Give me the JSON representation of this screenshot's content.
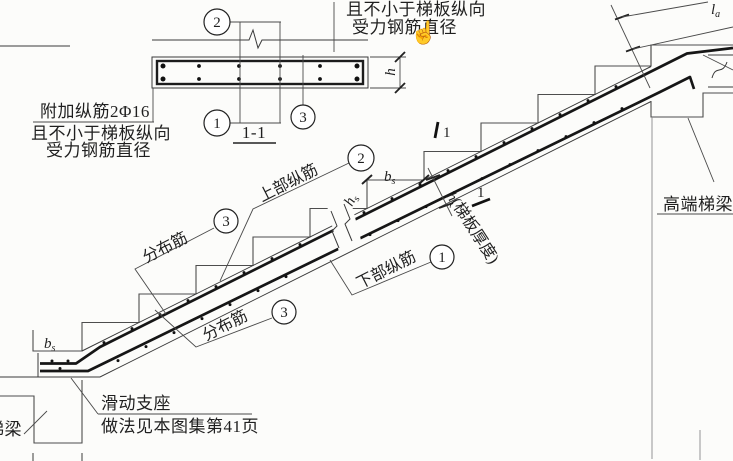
{
  "drawing_type": "stair-slab-reinforcement-detail",
  "section_detail": {
    "title": "1-1",
    "callout_top": "2",
    "callout_bottom": "1",
    "callout_right": "3",
    "h_label": "h"
  },
  "left_note": {
    "line1": "附加纵筋2Φ16",
    "line2": "且不小于梯板纵向",
    "line3": "受力钢筋直径"
  },
  "top_note": {
    "line1": "且不小于梯板纵向",
    "line2": "受力钢筋直径"
  },
  "cursor_glyph": "☝",
  "stair_labels": {
    "upper_bars": "上部纵筋",
    "upper_bars_callout": "2",
    "dist_bars_upper": "分布筋",
    "dist_bars_upper_callout": "3",
    "lower_bars": "下部纵筋",
    "lower_bars_callout": "1",
    "dist_bars_lower": "分布筋",
    "dist_bars_lower_callout": "3",
    "thickness_h": "h",
    "thickness_rest": "(梯板厚度)",
    "section_mark_num": "1",
    "bs_main": "b",
    "bs_sub": "s",
    "hs_main": "h",
    "hs_sub": "s",
    "la_main": "l",
    "la_sub": "a"
  },
  "supports": {
    "sliding_line1": "滑动支座",
    "sliding_line2": "做法见本图集第41页",
    "high_end_beam": "高端梯梁",
    "low_end_beam": "梯梁"
  },
  "colors": {
    "paper": "#fcfcfa",
    "ink": "#1f1f1f",
    "bar": "#161616",
    "outline": "#3a3a3a",
    "steps": "#4d4d4d",
    "leader": "#4a4a4a"
  }
}
